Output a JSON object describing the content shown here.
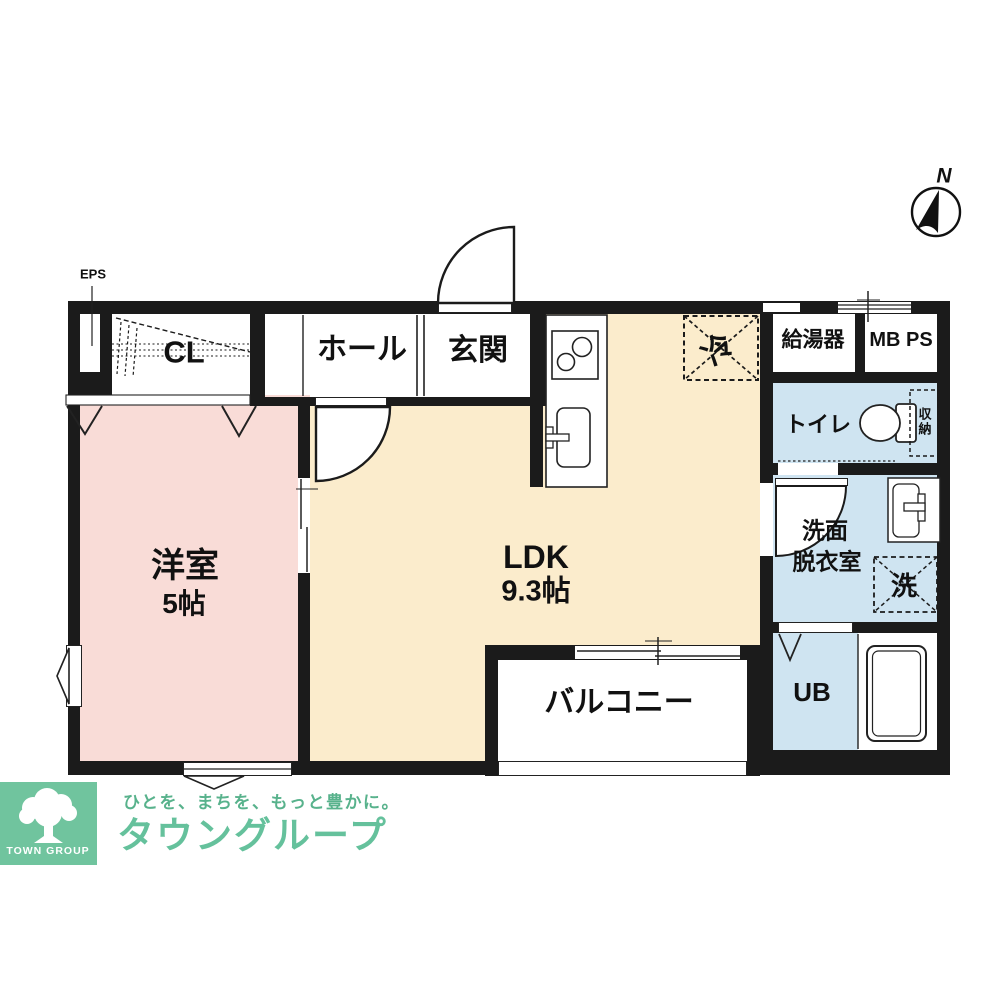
{
  "header": {
    "compass_north": "N",
    "eps_label": "EPS"
  },
  "plan": {
    "rooms": {
      "closet": "CL",
      "hall": "ホール",
      "entrance": "玄関",
      "refrigerator": "冷",
      "water_heater": "給湯器",
      "meter_pipe_space": "MB PS",
      "toilet": "トイレ",
      "storage": "収納",
      "washroom_line1": "洗面",
      "washroom_line2": "脱衣室",
      "washer": "洗",
      "unit_bath": "UB",
      "western_room": "洋室",
      "western_room_size": "5帖",
      "ldk": "LDK",
      "ldk_size": "9.3帖",
      "balcony": "バルコニー"
    },
    "colors": {
      "wall": "#1b1b1b",
      "western_room": "#f9dcd7",
      "ldk": "#fbeccc",
      "wet_area": "#cfe4f1",
      "line": "#222222"
    }
  },
  "footer": {
    "logo_text": "TOWN GROUP",
    "tagline": "ひとを、まちを、もっと豊かに。",
    "company": "タウングループ",
    "brand_green": "#70c49e",
    "company_green": "#65c19c",
    "tagline_green": "#58b28c"
  }
}
